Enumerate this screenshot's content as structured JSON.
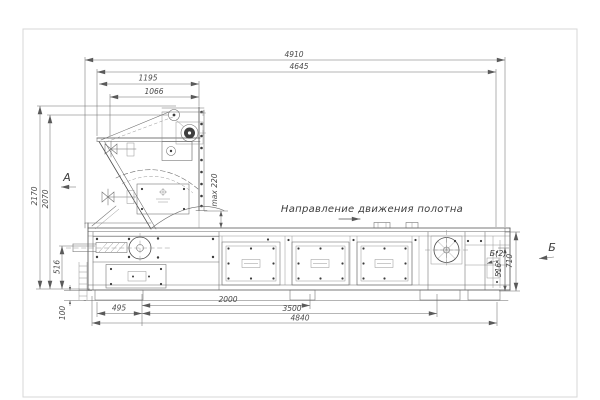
{
  "sheet": {
    "labels": {
      "direction": "Направление движения полотна",
      "view_a": "А",
      "view_b": "Б",
      "view_b2": "Б(2)"
    },
    "dimensions": {
      "top": {
        "overall": "4910",
        "second": "4645",
        "hopper_outer": "1195",
        "hopper_inner": "1066"
      },
      "left": {
        "total_height": "2170",
        "hopper_height": "2070",
        "belt_height": "516",
        "base_height": "100"
      },
      "right": {
        "frame_height": "710",
        "belt_height": "516"
      },
      "gap": {
        "max_clearance": "max 220"
      },
      "bottom": {
        "offset": "495",
        "drive_section": "2000",
        "frame_length": "3500",
        "base_length": "4840"
      }
    }
  }
}
